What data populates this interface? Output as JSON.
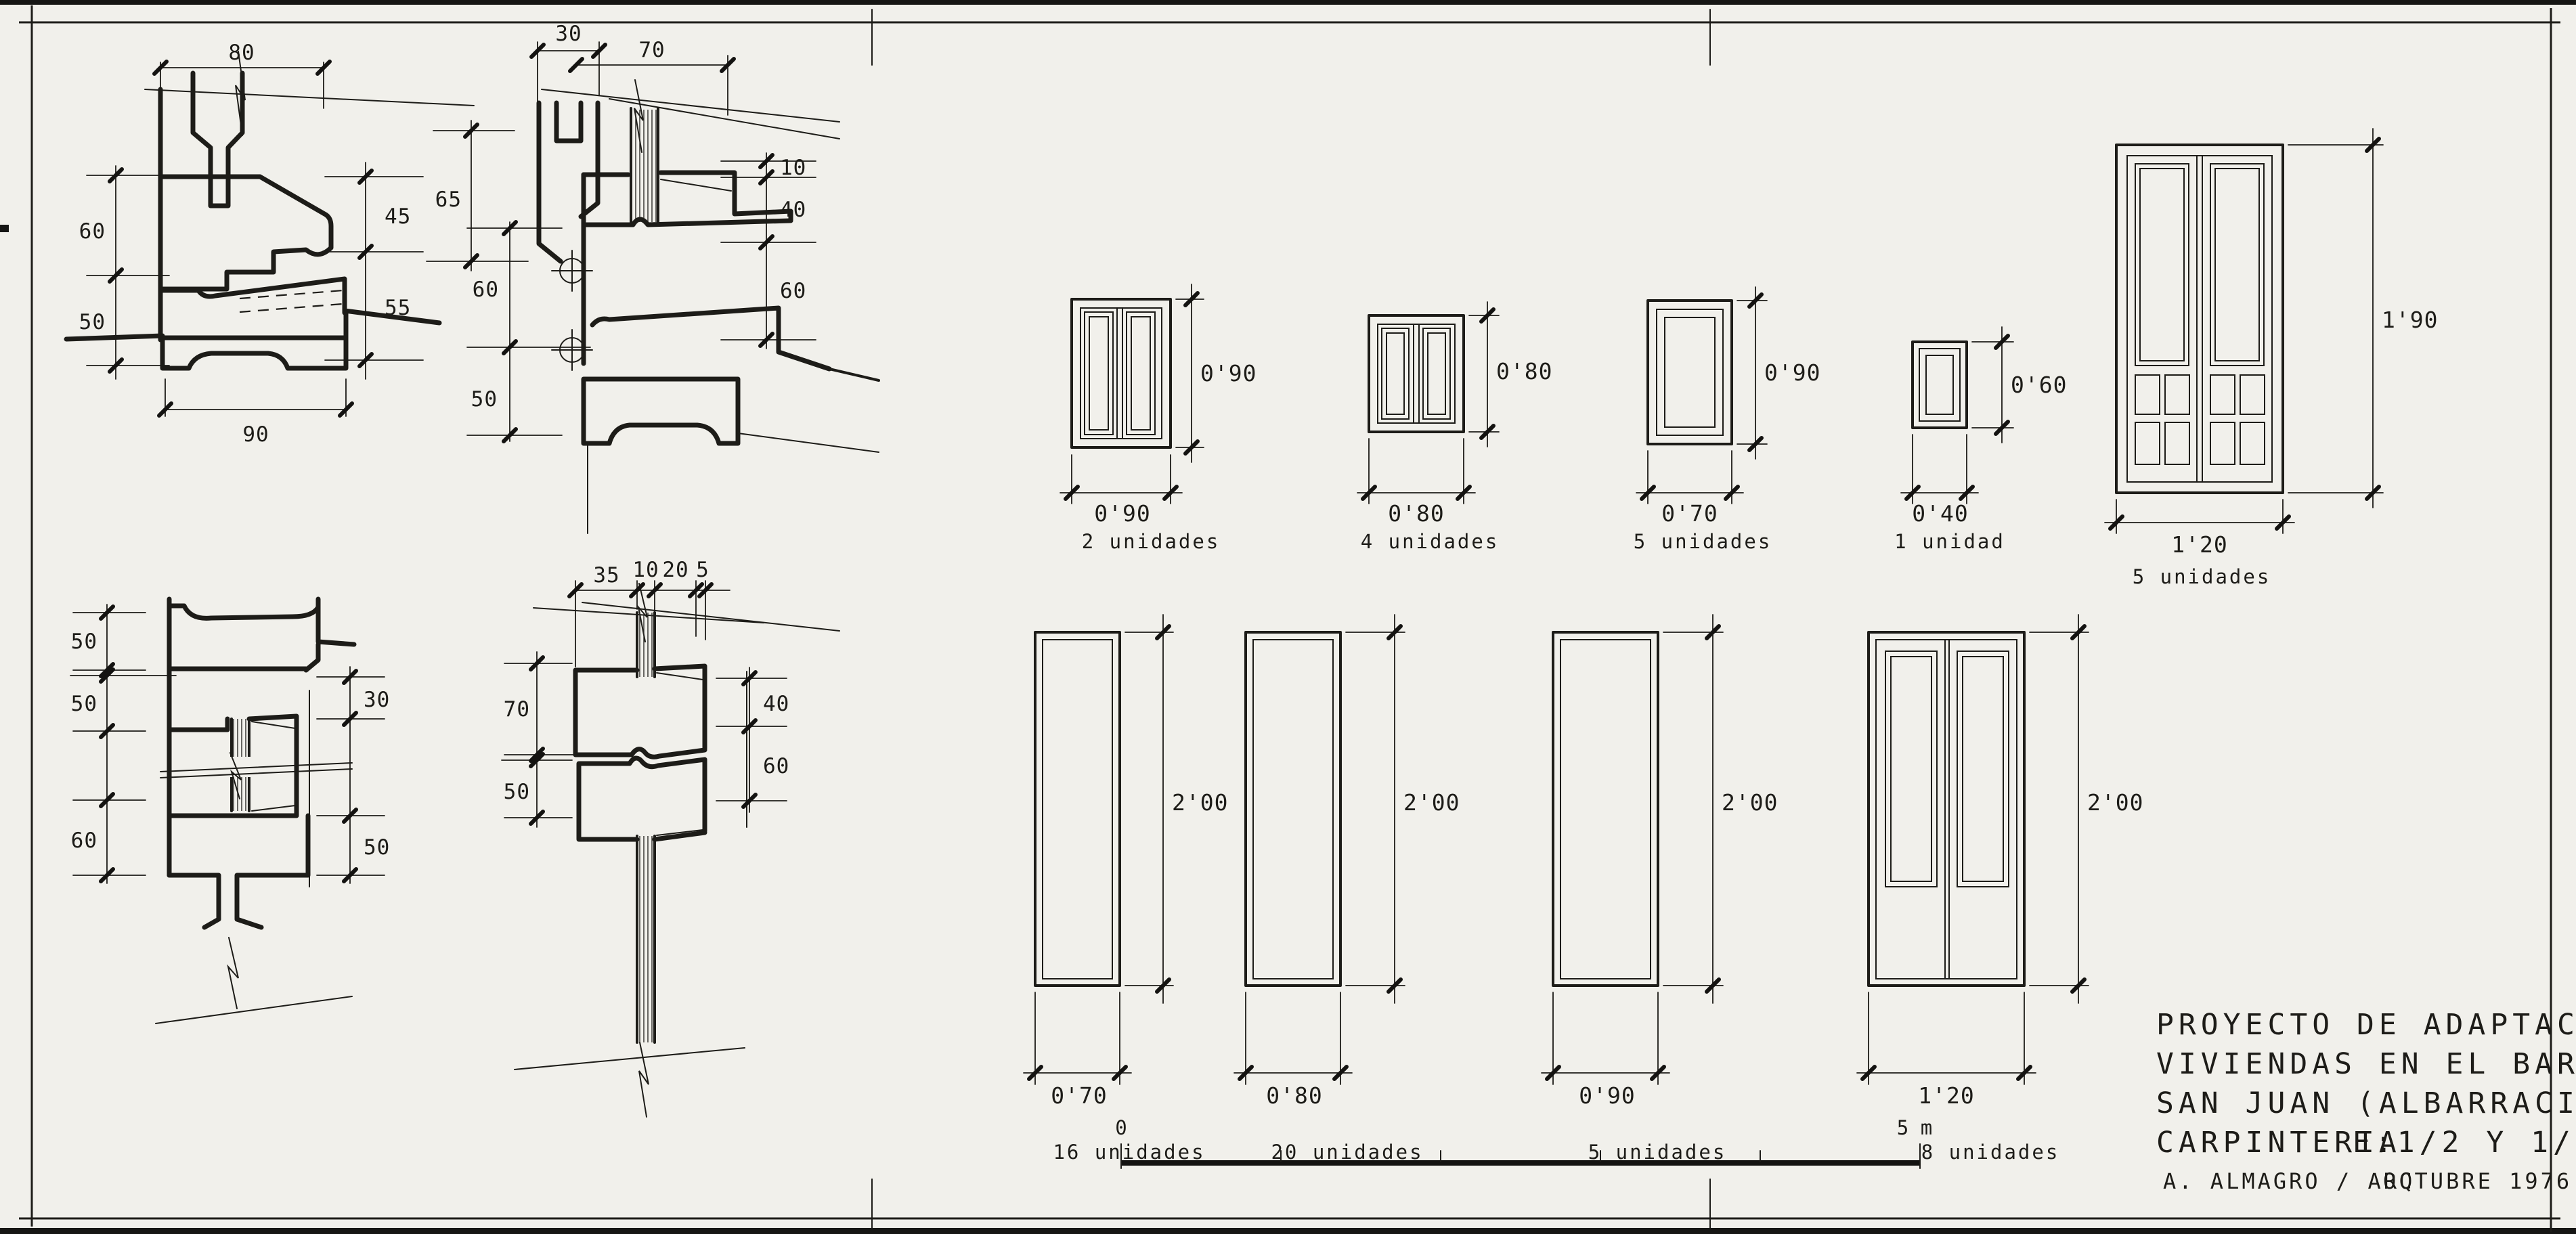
{
  "sheet": {
    "title_lines": [
      "PROYECTO DE ADAPTACION DE",
      "VIVIENDAS EN EL BARRIO DE",
      "SAN JUAN (ALBARRACIN)"
    ],
    "subject": "CARPINTERIA",
    "scale_note": "E:1/2 Y 1/25",
    "author": "A. ALMAGRO / ARQ",
    "date": "OCTUBRE 1976",
    "scale_bar": {
      "start_label": "0",
      "end_label": "5 m"
    },
    "colors": {
      "paper": "#f1f0eb",
      "ink": "#1d1c18"
    }
  },
  "details": {
    "sill_section": {
      "dims": {
        "top": "80",
        "left_upper": "60",
        "left_lower": "50",
        "right_upper": "45",
        "right_lower": "55",
        "bottom": "90"
      }
    },
    "head_section": {
      "dims": {
        "top_small": "30",
        "top_wide": "70",
        "left_upper": "65",
        "left_mid": "60",
        "left_lower": "50",
        "right_top": "10",
        "right_mid": "40",
        "right_bottom": "60"
      }
    },
    "jamb_vertical_section": {
      "dims": {
        "left_upper": "50",
        "left_mid": "50",
        "left_lower": "60",
        "right_upper": "30",
        "right_lower": "50"
      }
    },
    "meeting_stiles_section": {
      "dims": {
        "top_1": "35",
        "top_2": "10",
        "top_3": "20",
        "top_4": "5",
        "left_upper": "70",
        "left_lower": "50",
        "right_upper": "40",
        "right_lower": "60"
      }
    }
  },
  "windows": [
    {
      "width": "0'90",
      "height": "0'90",
      "count": "2 unidades"
    },
    {
      "width": "0'80",
      "height": "0'80",
      "count": "4 unidades"
    },
    {
      "width": "0'70",
      "height": "0'90",
      "count": "5 unidades"
    },
    {
      "width": "0'40",
      "height": "0'60",
      "count": "1 unidad"
    },
    {
      "width": "1'20",
      "height": "1'90",
      "count": "5 unidades"
    }
  ],
  "doors": [
    {
      "width": "0'70",
      "height": "2'00",
      "count": "16 unidades"
    },
    {
      "width": "0'80",
      "height": "2'00",
      "count": "20 unidades"
    },
    {
      "width": "0'90",
      "height": "2'00",
      "count": "5 unidades"
    },
    {
      "width": "1'20",
      "height": "2'00",
      "count": "8 unidades"
    }
  ]
}
